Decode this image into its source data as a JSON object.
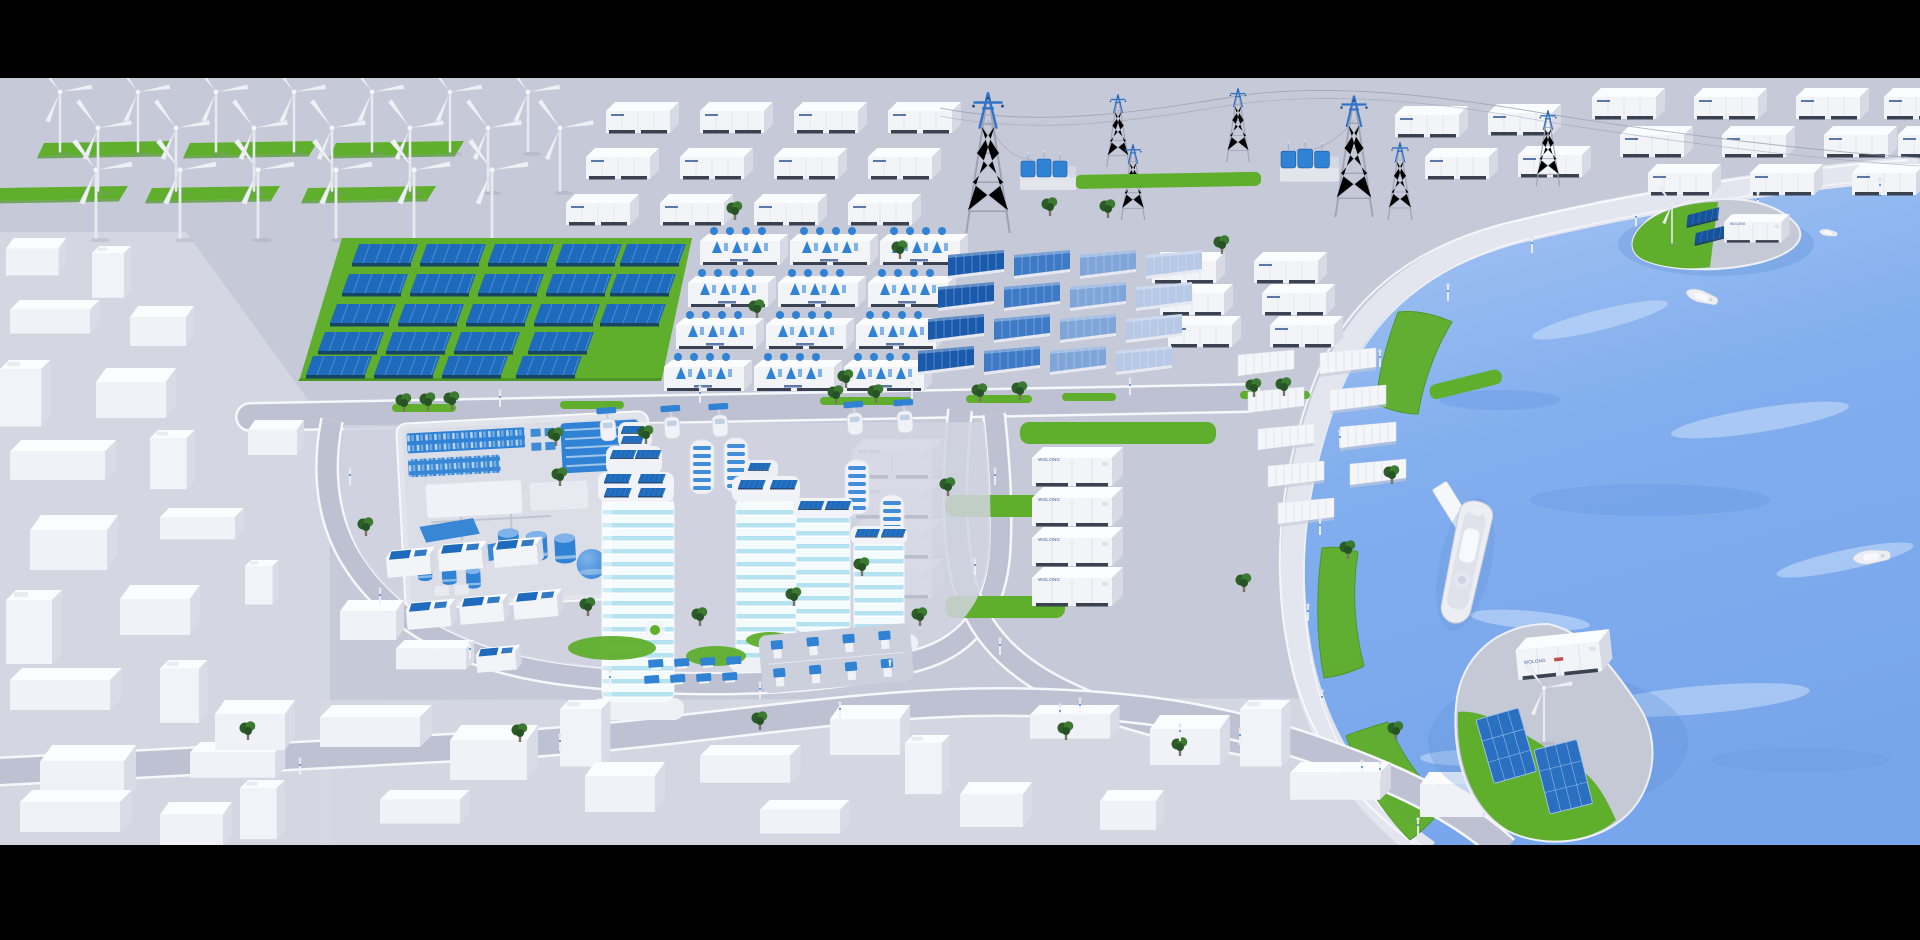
{
  "scene": {
    "description": "Isometric 3D render of a coastal smart clean-energy city with wind, solar, hydrogen and battery storage",
    "letterbox": {
      "top_height_px": 78,
      "bottom_height_px": 95
    }
  },
  "labels": {
    "container": "WOLONG"
  },
  "colors": {
    "bars": "#000000",
    "ground": "#c6c9d8",
    "groundLight": "#d6d9e4",
    "campusPad": "#d1d4e0",
    "road": "#bdc1d1",
    "roadEdge": "#f6f7fa",
    "grass": "#5fae2c",
    "grassDark": "#4c9723",
    "tree1": "#2c5d26",
    "tree2": "#3b7a30",
    "water1": "#a9c7f3",
    "water2": "#82aeee",
    "water3": "#78a6ec",
    "waveLight": "#cadef9",
    "waveDark": "#6f9fe8",
    "shadowWater": "#5d8fd8",
    "panel": "#1e6bbd",
    "panelDark": "#15539f",
    "panelEdge": "#123a6b",
    "white": "#f3f4f8",
    "boxTop": "#fbfcfe",
    "boxSide": "#d7dae4",
    "skid": "#3a4150",
    "steel": "#9ba2b3",
    "pylonBlue": "#3273c8",
    "glassBand": "#b5e2f0",
    "glassBase": "#f4fbfd",
    "tank": "#2f82d4",
    "tankLight": "#7fb3ea",
    "label": "#1c4488",
    "labelRed": "#b23333",
    "concrete": "#c5c9d6",
    "promenade": "#e4e6ef",
    "curb": "#f8f9fc",
    "hull": "#eceef4",
    "hullEdge": "#c6cad6"
  },
  "inventory": {
    "wind_turbines_onshore": 20,
    "wind_turbines_islands": 2,
    "battery_containers_north": 12,
    "battery_containers_east": 21,
    "battery_containers_yard": 8,
    "battery_containers_islands": 2,
    "electrolyzer_skids": 12,
    "solar_farm_panels": 23,
    "gradient_pv_walls": 16,
    "white_pv_walls": 9,
    "transmission_pylons": 7,
    "substations": 2,
    "glass_towers": 4,
    "greenhouses": 4,
    "solar_houses": 7,
    "street_ev_chargers": 5,
    "parking_ev_piles": 8,
    "solar_tables": 8,
    "ships": 1,
    "boats": 3,
    "trucks": 1,
    "islands": 2
  },
  "zones": [
    {
      "name": "wind-farm",
      "description": "3 rows of white wind turbines with green grass strips"
    },
    {
      "name": "battery-container-rows",
      "description": "white storage containers with small blue logos"
    },
    {
      "name": "transmission",
      "description": "lattice pylons with blue tops, power lines, two blue transformer substations"
    },
    {
      "name": "solar-farm",
      "description": "tilted blue PV panels on a green field"
    },
    {
      "name": "electrolyzer-skids",
      "description": "white skids topped with blue hydrogen modules"
    },
    {
      "name": "pv-wall-arrays",
      "description": "standing PV walls fading dark to light blue, white rows further east"
    },
    {
      "name": "container-yard",
      "description": "large white containers with blue logos and lawns"
    },
    {
      "name": "smart-campus",
      "description": "teal glass towers with rooftop solar, plant with blue tanks and sphere, solar houses, greenhouses, EV charging"
    },
    {
      "name": "city-blocks",
      "description": "untextured white low-poly city buildings"
    },
    {
      "name": "harbor",
      "description": "blue bay, curved promenade, ships, truck, two green islands with turbine, PV and container"
    }
  ]
}
